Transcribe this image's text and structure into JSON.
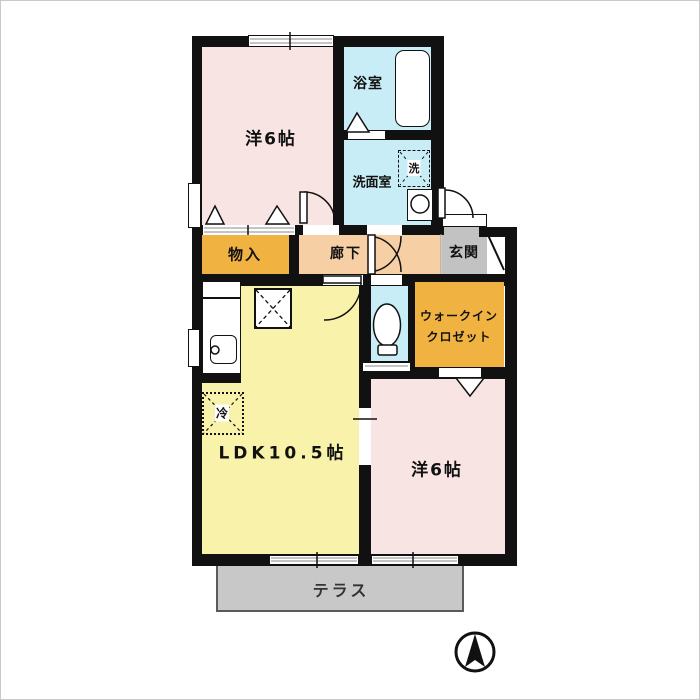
{
  "floorplan": {
    "title": "1LDK apartment floor plan",
    "rooms": {
      "bedroom_top": {
        "label": "洋6帖",
        "color": "#f9e4e4"
      },
      "bath": {
        "label": "浴室",
        "color": "#c9edf6"
      },
      "washroom": {
        "label": "洗面室",
        "color": "#c9edf6"
      },
      "washer": {
        "label": "洗"
      },
      "storage": {
        "label": "物入",
        "color": "#f0b342"
      },
      "hallway": {
        "label": "廊下",
        "color": "#f6d0a4"
      },
      "entrance": {
        "label": "玄関",
        "color": "#c2c2c2"
      },
      "toilet": {
        "color": "#c9edf6"
      },
      "wic": {
        "label_line1": "ウォークイン",
        "label_line2": "クロゼット",
        "color": "#f0b342"
      },
      "ldk": {
        "label": "LDK10.5帖",
        "color": "#f8f2aa"
      },
      "fridge": {
        "label": "冷"
      },
      "bedroom_bottom": {
        "label": "洋6帖",
        "color": "#f9e4e4"
      },
      "terrace": {
        "label": "テラス",
        "color": "#c8c8c8"
      }
    },
    "colors": {
      "wall": "#111111",
      "window": "#ffffff",
      "terrace_border": "#5a5a5a"
    },
    "compass": {
      "type": "north-arrow"
    }
  }
}
